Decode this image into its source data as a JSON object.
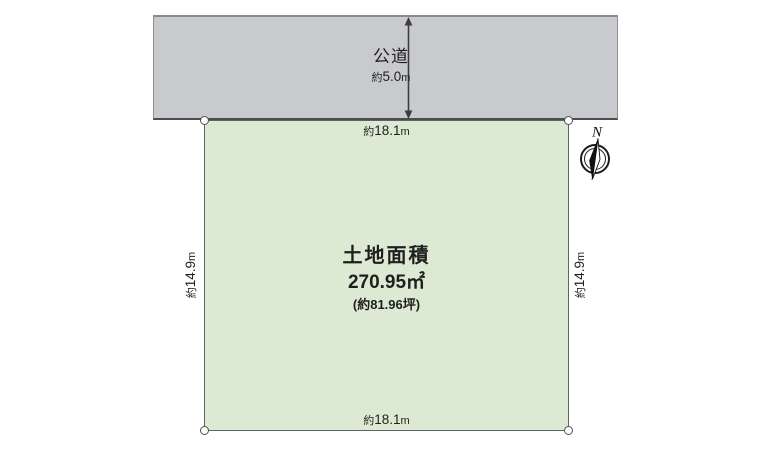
{
  "diagram": {
    "road": {
      "name": "公道",
      "width": {
        "prefix": "約",
        "value": "5.0",
        "unit": "m"
      }
    },
    "plot": {
      "area_title": "土地面積",
      "area_m2": "270.95㎡",
      "area_tsubo": "(約81.96坪)",
      "top_edge": {
        "prefix": "約",
        "value": "18.1",
        "unit": "m"
      },
      "bottom_edge": {
        "prefix": "約",
        "value": "18.1",
        "unit": "m"
      },
      "left_edge": {
        "prefix": "約",
        "value": "14.9",
        "unit": "m"
      },
      "right_edge": {
        "prefix": "約",
        "value": "14.9",
        "unit": "m"
      }
    },
    "compass": {
      "label": "N"
    },
    "colors": {
      "plot_fill": "#dcead4",
      "road_fill": "#c9cacd",
      "outline": "#5a5c5e",
      "text": "#1f1f1f"
    }
  }
}
